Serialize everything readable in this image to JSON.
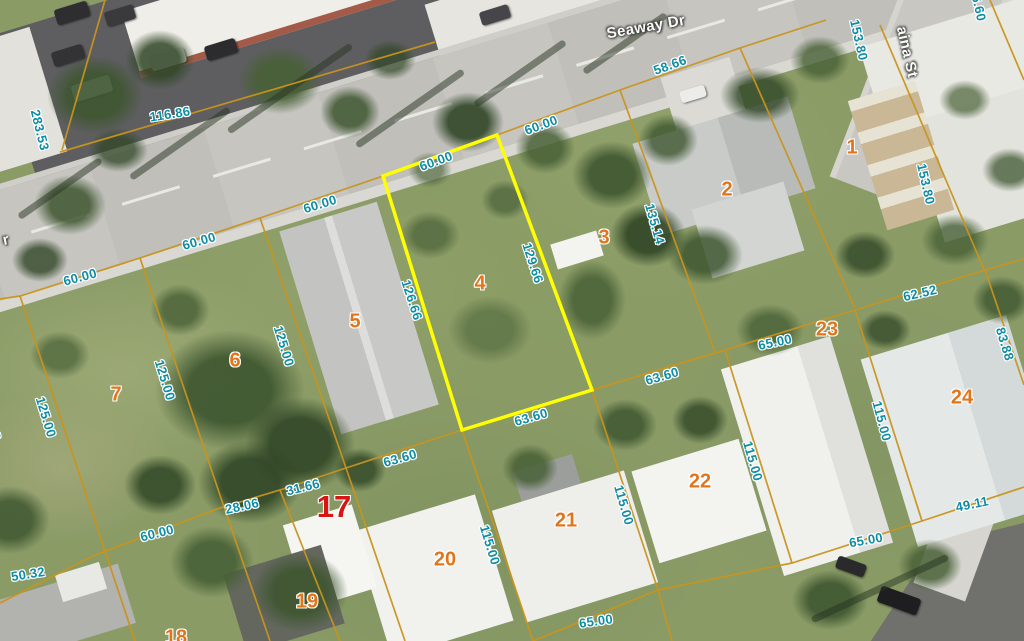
{
  "map": {
    "colors": {
      "dimension_text": "#0d8ca4",
      "parcel_number": "#e0761c",
      "parcel_number_highlight": "#d81414",
      "street_text": "#fbfbf8",
      "boundary_line": "#c8941e",
      "selected_parcel_outline": "#ffff00"
    },
    "streets": [
      {
        "name": "Seaway Dr",
        "x": 646,
        "y": 27,
        "angle": -10
      },
      {
        "name": "aina St",
        "x": 907,
        "y": 52,
        "angle": 77
      },
      {
        "name": "r",
        "x": 6,
        "y": 240,
        "angle": -12
      }
    ],
    "parcel_numbers": [
      {
        "n": "1",
        "x": 852,
        "y": 148
      },
      {
        "n": "2",
        "x": 727,
        "y": 190
      },
      {
        "n": "3",
        "x": 604,
        "y": 238
      },
      {
        "n": "4",
        "x": 480,
        "y": 284
      },
      {
        "n": "5",
        "x": 355,
        "y": 322
      },
      {
        "n": "6",
        "x": 235,
        "y": 361
      },
      {
        "n": "7",
        "x": 116,
        "y": 395
      },
      {
        "n": "17",
        "x": 334,
        "y": 507,
        "highlight": true
      },
      {
        "n": "18",
        "x": 176,
        "y": 638
      },
      {
        "n": "19",
        "x": 307,
        "y": 602
      },
      {
        "n": "20",
        "x": 445,
        "y": 560
      },
      {
        "n": "21",
        "x": 566,
        "y": 521
      },
      {
        "n": "22",
        "x": 700,
        "y": 482
      },
      {
        "n": "23",
        "x": 827,
        "y": 330
      },
      {
        "n": "24",
        "x": 962,
        "y": 398
      }
    ],
    "dimensions": [
      {
        "t": "283.53",
        "x": 40,
        "y": 130,
        "a": 76
      },
      {
        "t": "116.86",
        "x": 170,
        "y": 114,
        "a": -9
      },
      {
        "t": "58.66",
        "x": 670,
        "y": 65,
        "a": -20
      },
      {
        "t": "60.00",
        "x": 436,
        "y": 161,
        "a": -20
      },
      {
        "t": "60.00",
        "x": 541,
        "y": 125,
        "a": -20
      },
      {
        "t": "60.00",
        "x": 320,
        "y": 204,
        "a": -17
      },
      {
        "t": "60.00",
        "x": 199,
        "y": 241,
        "a": -16
      },
      {
        "t": "60.00",
        "x": 80,
        "y": 277,
        "a": -15
      },
      {
        "t": "126.66",
        "x": 412,
        "y": 300,
        "a": 72
      },
      {
        "t": "129.66",
        "x": 533,
        "y": 263,
        "a": 72
      },
      {
        "t": "135.14",
        "x": 655,
        "y": 224,
        "a": 74
      },
      {
        "t": "153.80",
        "x": 859,
        "y": 40,
        "a": 77
      },
      {
        "t": "153.80",
        "x": 926,
        "y": 184,
        "a": 77
      },
      {
        "t": "6.60",
        "x": 979,
        "y": 8,
        "a": 77
      },
      {
        "t": "62.52",
        "x": 920,
        "y": 293,
        "a": -13
      },
      {
        "t": "83.88",
        "x": 1005,
        "y": 344,
        "a": 73
      },
      {
        "t": "115.00",
        "x": 882,
        "y": 421,
        "a": 75
      },
      {
        "t": "65.00",
        "x": 775,
        "y": 342,
        "a": -12
      },
      {
        "t": "63.60",
        "x": 662,
        "y": 376,
        "a": -16
      },
      {
        "t": "63.60",
        "x": 531,
        "y": 417,
        "a": -16
      },
      {
        "t": "63.60",
        "x": 400,
        "y": 458,
        "a": -16
      },
      {
        "t": "31.66",
        "x": 303,
        "y": 487,
        "a": -14
      },
      {
        "t": "28.06",
        "x": 242,
        "y": 506,
        "a": -12
      },
      {
        "t": "60.00",
        "x": 157,
        "y": 533,
        "a": -14
      },
      {
        "t": "50.32",
        "x": 28,
        "y": 574,
        "a": -9
      },
      {
        "t": "115.00",
        "x": 490,
        "y": 545,
        "a": 73
      },
      {
        "t": "115.00",
        "x": 624,
        "y": 505,
        "a": 74
      },
      {
        "t": "115.00",
        "x": 753,
        "y": 461,
        "a": 74
      },
      {
        "t": "65.00",
        "x": 596,
        "y": 621,
        "a": -8
      },
      {
        "t": "65.00",
        "x": 866,
        "y": 540,
        "a": -10
      },
      {
        "t": "49.11",
        "x": 972,
        "y": 504,
        "a": -12
      },
      {
        "t": "125.00",
        "x": 46,
        "y": 417,
        "a": 73
      },
      {
        "t": "125.00",
        "x": 165,
        "y": 380,
        "a": 73
      },
      {
        "t": "125.00",
        "x": 284,
        "y": 346,
        "a": 73
      },
      {
        "t": "3",
        "x": -4,
        "y": 436,
        "a": 75
      }
    ],
    "selected_parcel": {
      "number": "4",
      "outline": [
        [
          383,
          176
        ],
        [
          497,
          135
        ],
        [
          592,
          390
        ],
        [
          462,
          430
        ]
      ]
    },
    "boundaries": [
      [
        [
          0,
          299
        ],
        [
          20,
          296
        ],
        [
          140,
          258
        ],
        [
          260,
          218
        ],
        [
          383,
          176
        ]
      ],
      [
        [
          497,
          135
        ],
        [
          620,
          90
        ],
        [
          740,
          48
        ],
        [
          826,
          20
        ]
      ],
      [
        [
          0,
          603
        ],
        [
          95,
          555
        ],
        [
          220,
          508
        ],
        [
          280,
          490
        ],
        [
          346,
          468
        ],
        [
          462,
          430
        ]
      ],
      [
        [
          592,
          390
        ],
        [
          725,
          350
        ],
        [
          855,
          310
        ],
        [
          985,
          270
        ],
        [
          1024,
          259
        ]
      ],
      [
        [
          20,
          296
        ],
        [
          105,
          551
        ],
        [
          135,
          641
        ]
      ],
      [
        [
          140,
          258
        ],
        [
          225,
          510
        ],
        [
          270,
          641
        ]
      ],
      [
        [
          260,
          218
        ],
        [
          346,
          468
        ],
        [
          405,
          641
        ]
      ],
      [
        [
          280,
          490
        ],
        [
          340,
          641
        ]
      ],
      [
        [
          462,
          430
        ],
        [
          533,
          641
        ]
      ],
      [
        [
          592,
          390
        ],
        [
          658,
          590
        ],
        [
          672,
          641
        ]
      ],
      [
        [
          725,
          350
        ],
        [
          792,
          563
        ]
      ],
      [
        [
          855,
          310
        ],
        [
          922,
          521
        ]
      ],
      [
        [
          620,
          90
        ],
        [
          715,
          352
        ]
      ],
      [
        [
          740,
          48
        ],
        [
          855,
          308
        ]
      ],
      [
        [
          880,
          25
        ],
        [
          985,
          272
        ]
      ],
      [
        [
          985,
          270
        ],
        [
          1024,
          385
        ]
      ],
      [
        [
          533,
          641
        ],
        [
          658,
          590
        ],
        [
          792,
          563
        ],
        [
          922,
          521
        ],
        [
          1024,
          487
        ]
      ],
      [
        [
          105,
          0
        ],
        [
          62,
          150
        ]
      ],
      [
        [
          60,
          152
        ],
        [
          435,
          42
        ]
      ],
      [
        [
          990,
          0
        ],
        [
          1024,
          80
        ]
      ]
    ]
  }
}
